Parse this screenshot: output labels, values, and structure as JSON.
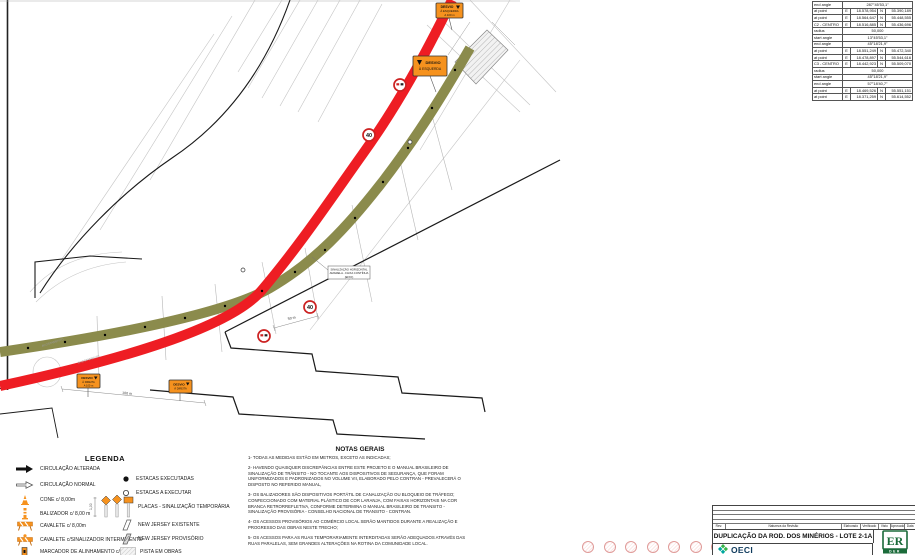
{
  "colors": {
    "new_lane_red": "#ee1d23",
    "detour_olive": "#8b8b4c",
    "sign_orange": "#f6921e",
    "construction_gray": "#c4c4c4",
    "der_green": "#1b6b3a",
    "oeci_teal": "#00a79d",
    "oeci_green": "#39b54a"
  },
  "coord_table": {
    "east_label": "E",
    "north_label": "N",
    "rows": [
      {
        "label": "end angle",
        "value": "287°45'53,1\""
      },
      {
        "label": "at point",
        "e": "18.578,954",
        "n": "55.390,189"
      },
      {
        "label": "at point",
        "e": "18.564,647",
        "n": "55.448,555"
      },
      {
        "label": "C2 - CENTRO",
        "e": "18.516,885",
        "n": "55.436,696"
      },
      {
        "label": "radius",
        "value": "50,000"
      },
      {
        "label": "start angle",
        "value": "13°45'53,1\""
      },
      {
        "label": "end angle",
        "value": "45°18'21,9\""
      },
      {
        "label": "at point",
        "e": "18.551,249",
        "n": "55.472,340"
      },
      {
        "label": "at point",
        "e": "18.478,897",
        "n": "55.544,616"
      },
      {
        "label": "C3 - CENTRO",
        "e": "18.442,923",
        "n": "55.509,070"
      },
      {
        "label": "radius",
        "value": "50,000"
      },
      {
        "label": "start angle",
        "value": "45°18'21,9\""
      },
      {
        "label": "end angle",
        "value": "57°18'40,7\""
      },
      {
        "label": "at point",
        "e": "18.469,526",
        "n": "55.551,151"
      },
      {
        "label": "at point",
        "e": "18.371,259",
        "n": "55.614,552"
      }
    ]
  },
  "map": {
    "speed_sign": "40",
    "dim_50m": "50 m",
    "dim_100m": "100 m",
    "signal_box": [
      "SINALIZAÇÃO HORIZONTAL",
      "AMARELA - FAIXA CONTÍNUA",
      "(EIXO)"
    ],
    "street_label": "ACOSTAMENTO",
    "sign_top1": {
      "l1": "DESVIO",
      "l2": "À ESQUERDA",
      "l3": "A 100 m"
    },
    "sign_top2": {
      "l1": "DESVIO",
      "l2": "À ESQUERDA"
    },
    "sign_bottom1": {
      "l1": "DESVIO",
      "l2": "À DIREITA",
      "l3": "A 100 m"
    },
    "sign_bottom2": {
      "l1": "DESVIO",
      "l2": "À DIREITA"
    }
  },
  "legend": {
    "title": "LEGENDA",
    "placas_dim": "1,00",
    "left": [
      {
        "label": "CIRCULAÇÃO ALTERADA"
      },
      {
        "label": "CIRCULAÇÃO NORMAL"
      },
      {
        "label": "CONE c/ 8,00m"
      },
      {
        "label": "BALIZADOR c/ 8,00 m"
      },
      {
        "label": "CAVALETE c/ 8,00m"
      },
      {
        "label": "CAVALETE c/SINALIZADOR INTERMITENTE"
      },
      {
        "label": "MARCADOR DE ALINHAMENTO c/ 8,00m"
      }
    ],
    "right": [
      {
        "label": "ESTACAS EXECUTADAS"
      },
      {
        "label": "ESTACAS A EXECUTAR"
      },
      {
        "label": "PLACAS - SINALIZAÇÃO TEMPORÁRIA"
      },
      {
        "label": "NEW JERSEY EXISTENTE"
      },
      {
        "label": "NEW JERSEY PROVISÓRIO"
      },
      {
        "label": "PISTA EM OBRAS"
      }
    ]
  },
  "notes": {
    "title": "NOTAS GERAIS",
    "items": [
      "1- TODAS AS MEDIDAS ESTÃO EM METROS, EXCETO AS INDICADAS;",
      "2- HAVENDO QUAISQUER DISCREPÂNCIAS ENTRE ESTE PROJETO E O MANUAL BRASILEIRO DE SINALIZAÇÃO DE TRÂNSITO - NO TOCANTE AOS DISPOSITIVOS DE SEGURANÇA, QUE FORAM UNIFORMIZADOS E PADRONIZADOS NO  VOLUME VII, ELABORADO PELO CONTRAN - PREVALECERÁ O DISPOSTO NO REFERIDO MANUAL,",
      "3- OS BALIZADORES SÃO DISPOSITIVOS PORTÁTIL DE CANALIZAÇÃO OU BLOQUEIO DE TRÁFEGO; CONFECCIONADO COM MATERIAL PLÁSTICO DE COR LARANJA, COM FAIXAS HORIZONTAIS NA COR BRANCA RETRORREFLETIVA, CONFORME DETERMINA O MANUAL BRASILEIRO DE TRANSITO - SINALIZAÇÃO PROVISÓRIA - CONSELHO NACIONAL DE TRANSITO - CONTRAN.",
      "4- OS ACESSOS PROVISÓRIOS AO COMÉRCIO LOCAL SERÃO MANTIDOS DURANTE A REALIZAÇÃO E PROGRESSO DAS OBRAS NESTE TRECHO;",
      "5- OS ACESSOS PARA AS RUAS TEMPORARIAMENTE INTERDITADAS SERÃO ADEQUADOS ATRAVÉS DAS RUAS PARALELAS, SEM GRANDES ALTERAÇÕES NA ROTINA DA COMUNIDADE LOCAL."
    ]
  },
  "titleblock": {
    "title": "DUPLICAÇÃO DA ROD. DOS MINÉRIOS - LOTE 2-1A",
    "columns": [
      "Rev.",
      "Natureza da Revisão",
      "Elaborado",
      "Verificado",
      "Visto",
      "Aprovado",
      "Data"
    ],
    "oeci": "OECI",
    "der": "DER",
    "der_mono": "ER"
  }
}
